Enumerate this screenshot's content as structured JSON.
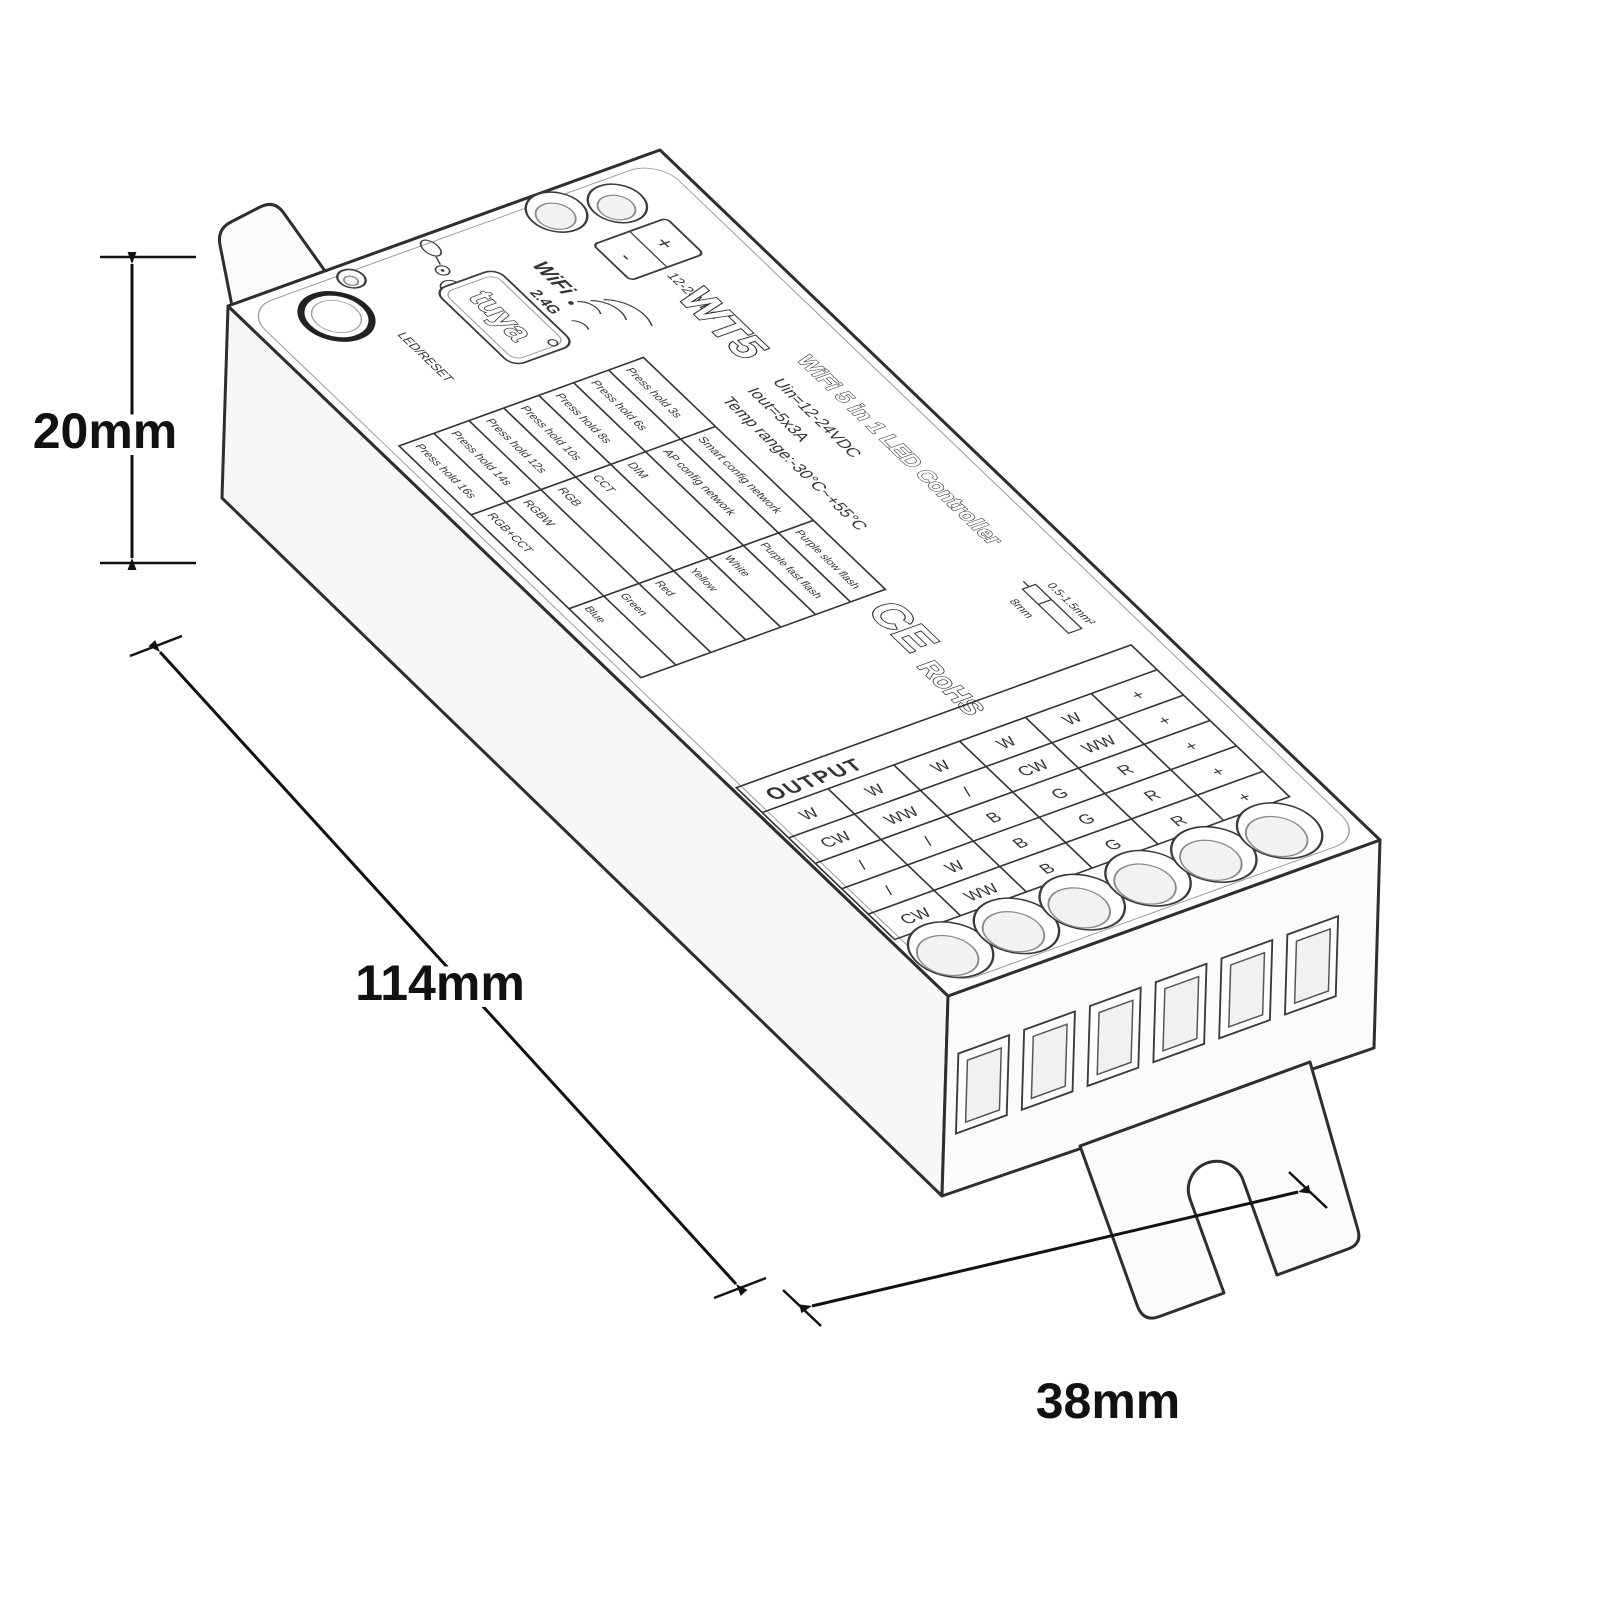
{
  "dimensions": {
    "height": "20mm",
    "length": "114mm",
    "depth": "38mm"
  },
  "top_label": {
    "model": "WT5",
    "title": "WiFi 5 in 1 LED Controller",
    "brand": "tuya",
    "wifi": {
      "name": "WiFi",
      "band": "2.4G"
    },
    "button_text": "LED/RESET",
    "power": {
      "plus": "+",
      "minus": "-",
      "rating": "12-24VDC"
    },
    "specs": {
      "input": "Uin=12-24VDC",
      "output": "Iout=5x3A",
      "temp": "Temp range:-30°C~+55°C"
    },
    "certs": {
      "ce": "CE",
      "rohs": "RoHS"
    },
    "wire": {
      "gauge": "0.5-1.5mm²",
      "strip_length": "8mm"
    },
    "mode_table": {
      "rows": [
        {
          "hold": "Press hold 3s",
          "mode": "Smart config network",
          "led": "Purple slow flash"
        },
        {
          "hold": "Press hold 6s",
          "mode": "AP config network",
          "led": "Purple fast flash"
        },
        {
          "hold": "Press hold 8s",
          "mode": "DIM",
          "led": "White"
        },
        {
          "hold": "Press hold 10s",
          "mode": "CCT",
          "led": "Yellow"
        },
        {
          "hold": "Press hold 12s",
          "mode": "RGB",
          "led": "Red"
        },
        {
          "hold": "Press hold 14s",
          "mode": "RGBW",
          "led": "Green"
        },
        {
          "hold": "Press hold 16s",
          "mode": "RGB+CCT",
          "led": "Blue"
        }
      ]
    },
    "output_table": {
      "header": "OUTPUT",
      "rows": [
        [
          "W",
          "W",
          "W",
          "W",
          "W",
          "+"
        ],
        [
          "CW",
          "WW",
          "/",
          "CW",
          "WW",
          "+"
        ],
        [
          "/",
          "/",
          "B",
          "G",
          "R",
          "+"
        ],
        [
          "/",
          "W",
          "B",
          "G",
          "R",
          "+"
        ],
        [
          "CW",
          "WW",
          "B",
          "G",
          "R",
          "+"
        ]
      ]
    }
  }
}
